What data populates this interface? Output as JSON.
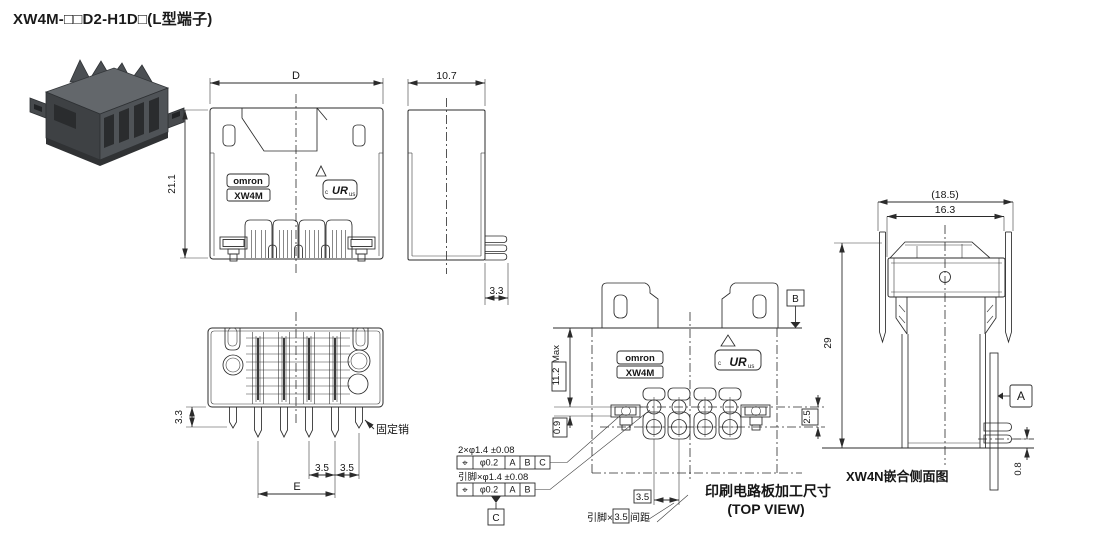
{
  "title": "XW4M-□□D2-H1D□(L型端子)",
  "colors": {
    "line": "#2b2b2b",
    "text": "#161616",
    "photo_dark": "#3e4144",
    "photo_mid": "#4f5357",
    "photo_light": "#63676b"
  },
  "brand": {
    "omron": "omron",
    "model": "XW4M",
    "ul_c": "c",
    "ul_mark": "UR",
    "ul_us": "us"
  },
  "front_view": {
    "dim_width": "D",
    "dim_height": "21.1"
  },
  "side_view": {
    "dim_width": "10.7",
    "dim_pin_protrusion": "3.3"
  },
  "bottom_view": {
    "dim_pin_length": "3.3",
    "fixing_pin_label": "固定销",
    "dim_pitch_a": "3.5",
    "dim_pitch_b": "3.5",
    "dim_span": "E"
  },
  "pcb_view": {
    "datum_b": "B",
    "datum_c": "C",
    "dim_body_max": "11.2",
    "dim_body_max_suffix": "Max",
    "dim_offset": "0.9",
    "dim_row_spacing": "2.5",
    "dim_hole_pitch": "3.5",
    "pitch_note_prefix": "引脚×",
    "pitch_note_value": "3.5",
    "pitch_note_suffix": "间距",
    "callout_fixing": {
      "label": "2×φ1.4 ±0.08",
      "symbol": "⌖",
      "tolerance": "φ0.2",
      "datums": [
        "A",
        "B",
        "C"
      ]
    },
    "callout_pins": {
      "label": "引脚×φ1.4 ±0.08",
      "symbol": "⌖",
      "tolerance": "φ0.2",
      "datums": [
        "A",
        "B"
      ]
    },
    "caption_line1": "印刷电路板加工尺寸",
    "caption_line2": "(TOP VIEW)"
  },
  "mating_view": {
    "dim_outer_ref": "(18.5)",
    "dim_inner": "16.3",
    "dim_height": "29",
    "datum_a": "A",
    "dim_pcb_offset": "0.8",
    "caption": "XW4N嵌合侧面图"
  }
}
